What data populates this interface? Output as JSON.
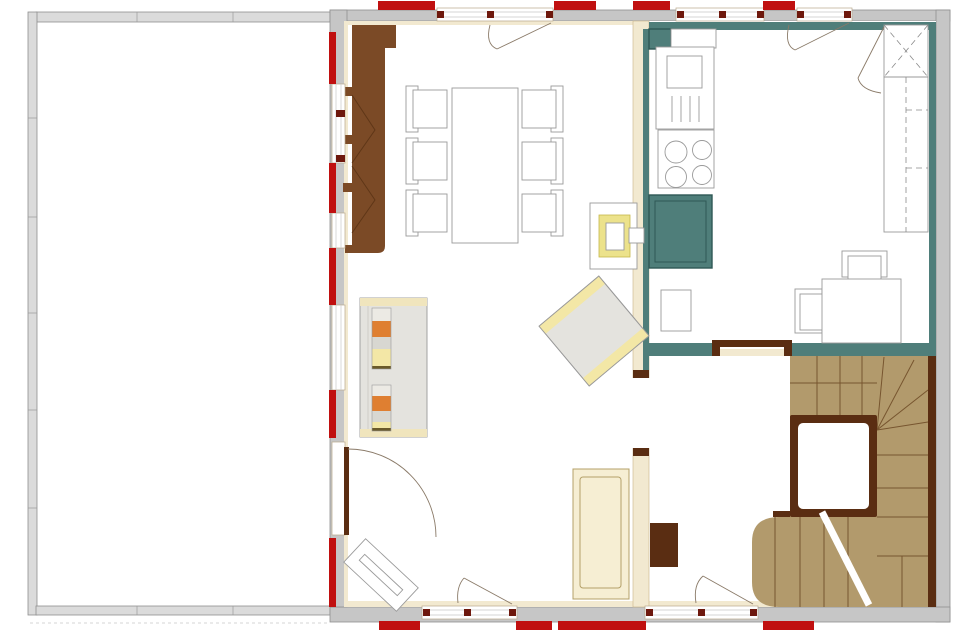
{
  "title": "ground-floor-plan",
  "palette": {
    "wall-gray": "#c6c6c6",
    "wall-stroke": "#8f8f8f",
    "terrace-wall": "#dbdbdb",
    "red": "#c01010",
    "mullion": "#6e180d",
    "cream": "#f2e9d0",
    "cream-stroke": "#c8b488",
    "teal": "#4f7e7a",
    "teal-dark": "#2f5855",
    "brown": "#7b4a26",
    "brown-dark": "#5a2d12",
    "tan": "#b29a6c",
    "tread": "#77552f",
    "fur-stroke": "#9a9a9a",
    "gray-fill": "#e4e3de",
    "yellow": "#ece28b",
    "pale-yellow": "#f3e7a6",
    "orange": "#df7f31",
    "sofa-cream": "#f6eed3",
    "sofa-stroke": "#b4a068",
    "band-cream": "#f0e5bd",
    "arc": "#8a7a68"
  },
  "plan": {
    "rooms": [
      {
        "name": "terrace",
        "floor": "#ffffff"
      },
      {
        "name": "living-dining-room",
        "floor": "#ffffff"
      },
      {
        "name": "kitchen-bedroom",
        "floor": "#ffffff"
      },
      {
        "name": "hall",
        "floor": "#ffffff"
      },
      {
        "name": "staircase",
        "floor": "#b29a6c"
      }
    ],
    "window_markers_red": {
      "top": 4,
      "bottom": 4,
      "west": 5
    },
    "doors": [
      "top-living-french-door",
      "top-bedroom-french-door",
      "west-terrace-door",
      "living-hall-doorway",
      "kitchen-hall-door",
      "bottom-living-door",
      "bottom-entrance-door"
    ],
    "furniture": [
      {
        "name": "wardrobe-brown",
        "room": "living-dining-room"
      },
      {
        "name": "dining-table",
        "chairs": 6
      },
      {
        "name": "tiled-stove",
        "accent": "#ece28b"
      },
      {
        "name": "sideboard-with-books"
      },
      {
        "name": "armchair-rotated"
      },
      {
        "name": "sofa"
      },
      {
        "name": "lounger-rotated"
      },
      {
        "name": "oven-tower"
      },
      {
        "name": "cooktop",
        "burners": 4
      },
      {
        "name": "sink-counter"
      },
      {
        "name": "dishwasher"
      },
      {
        "name": "x-wardrobe"
      },
      {
        "name": "closet-dashed"
      },
      {
        "name": "desk",
        "chairs": 2
      },
      {
        "name": "hall-cabinet"
      },
      {
        "name": "winder-staircase",
        "void": true
      }
    ]
  }
}
